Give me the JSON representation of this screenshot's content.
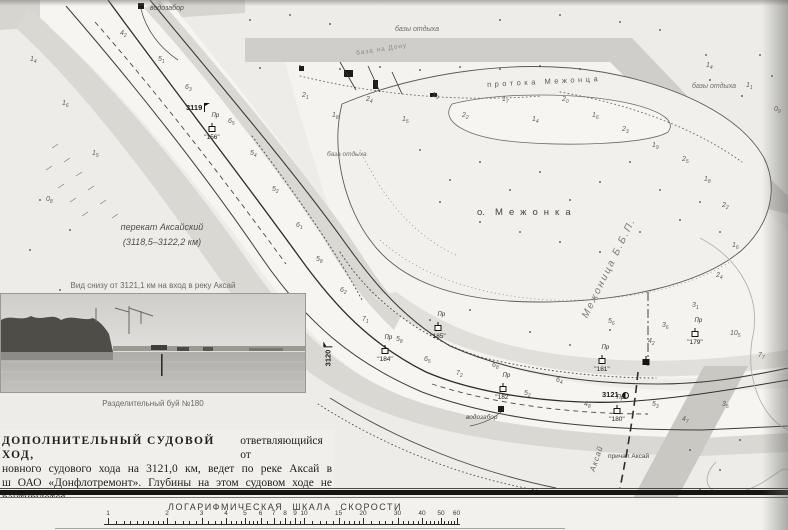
{
  "map": {
    "labels": {
      "vodozabor_top": "водозабор",
      "bazy_otdykha_top": "базы отдыха",
      "baza_na_donu": "база на Дону",
      "bazy_otdykha_right": "базы отдыха",
      "baza_otdykha_mid": "база отдыха",
      "protoka": "протока Межонца",
      "island_prefix": "о.",
      "island_name": "Межонка",
      "perekat_line1": "перекат Аксайский",
      "perekat_line2": "(3118,5–3122,2 км)",
      "side_channel": "Межоница Б.Б.П.",
      "vodozabor_bottom": "водозабор",
      "prichal": "причал Аксай",
      "aksay_river": "Аксай"
    },
    "buoy_prefix": "Пр",
    "km_markers": [
      {
        "x": 186,
        "y": 103,
        "label": "3119",
        "rot": 0,
        "sym": "flag"
      },
      {
        "x": 318,
        "y": 352,
        "label": "3120",
        "rot": -90,
        "sym": "flag"
      },
      {
        "x": 602,
        "y": 390,
        "label": "3121",
        "rot": 0,
        "sym": "circle"
      }
    ],
    "buoys": [
      {
        "x": 212,
        "y": 129,
        "num": "\"156\"",
        "black": false
      },
      {
        "x": 385,
        "y": 351,
        "num": "\"184\"",
        "black": false
      },
      {
        "x": 438,
        "y": 328,
        "num": "\"185\"",
        "black": false
      },
      {
        "x": 503,
        "y": 389,
        "num": "\"182\"",
        "black": false
      },
      {
        "x": 602,
        "y": 361,
        "num": "\"181\"",
        "black": false
      },
      {
        "x": 617,
        "y": 411,
        "num": "\"180\"",
        "black": false
      },
      {
        "x": 695,
        "y": 334,
        "num": "\"179\"",
        "black": false
      },
      {
        "x": 646,
        "y": 362,
        "num": "",
        "black": true
      }
    ],
    "depths": [
      [
        120,
        30,
        "4",
        "2"
      ],
      [
        158,
        56,
        "5",
        "1"
      ],
      [
        185,
        84,
        "6",
        "3"
      ],
      [
        228,
        118,
        "6",
        "5"
      ],
      [
        250,
        150,
        "5",
        "4"
      ],
      [
        272,
        186,
        "5",
        "2"
      ],
      [
        296,
        222,
        "6",
        "1"
      ],
      [
        316,
        256,
        "5",
        "8"
      ],
      [
        340,
        287,
        "6",
        "2"
      ],
      [
        362,
        316,
        "7",
        "1"
      ],
      [
        396,
        336,
        "5",
        "8"
      ],
      [
        424,
        356,
        "6",
        "5"
      ],
      [
        456,
        370,
        "7",
        "2"
      ],
      [
        492,
        362,
        "6",
        "8"
      ],
      [
        524,
        390,
        "5",
        "2"
      ],
      [
        556,
        377,
        "6",
        "4"
      ],
      [
        584,
        401,
        "4",
        "8"
      ],
      [
        652,
        401,
        "5",
        "3"
      ],
      [
        682,
        416,
        "4",
        "7"
      ],
      [
        722,
        401,
        "3",
        "5"
      ],
      [
        30,
        56,
        "1",
        "4"
      ],
      [
        62,
        100,
        "1",
        "6"
      ],
      [
        92,
        150,
        "1",
        "5"
      ],
      [
        46,
        196,
        "0",
        "8"
      ],
      [
        302,
        92,
        "2",
        "1"
      ],
      [
        332,
        112,
        "1",
        "8"
      ],
      [
        366,
        96,
        "2",
        "4"
      ],
      [
        402,
        116,
        "1",
        "5"
      ],
      [
        432,
        92,
        "1",
        "9"
      ],
      [
        462,
        112,
        "2",
        "2"
      ],
      [
        502,
        96,
        "1",
        "7"
      ],
      [
        532,
        116,
        "1",
        "4"
      ],
      [
        562,
        96,
        "2",
        "0"
      ],
      [
        592,
        112,
        "1",
        "6"
      ],
      [
        622,
        126,
        "2",
        "3"
      ],
      [
        652,
        142,
        "1",
        "9"
      ],
      [
        682,
        156,
        "2",
        "5"
      ],
      [
        704,
        176,
        "1",
        "8"
      ],
      [
        722,
        202,
        "2",
        "2"
      ],
      [
        732,
        242,
        "1",
        "6"
      ],
      [
        716,
        272,
        "2",
        "4"
      ],
      [
        692,
        302,
        "3",
        "1"
      ],
      [
        662,
        322,
        "3",
        "6"
      ],
      [
        706,
        62,
        "1",
        "4"
      ],
      [
        746,
        82,
        "1",
        "1"
      ],
      [
        774,
        106,
        "0",
        "9"
      ],
      [
        608,
        318,
        "5",
        "6"
      ],
      [
        648,
        338,
        "4",
        "2"
      ],
      [
        730,
        330,
        "10",
        "5"
      ],
      [
        758,
        352,
        "7",
        "7"
      ]
    ]
  },
  "photo": {
    "caption_top": "Вид снизу от 3121,1 км на вход в реку Аксай",
    "caption_bottom": "Разделительный буй №180"
  },
  "note": {
    "line1_bold": "ДОПОЛНИТЕЛЬНЫЙ СУДОВОЙ ХОД,",
    "line1_rest": "ответвляющийся от",
    "line2": "новного судового хода на 3121,0 км, ведет по реке Аксай в",
    "line3": "ш ОАО «Донфлотремонт». Глубины на этом судовом ходе не",
    "line4": "рантируются."
  },
  "speed_scale": {
    "title": "ЛОГАРИФМИЧЕСКАЯ ШКАЛА СКОРОСТИ",
    "major_ticks": [
      1,
      2,
      3,
      4,
      5,
      6,
      7,
      8,
      9,
      10,
      15,
      20,
      30,
      40,
      50,
      60
    ],
    "minor_ticks": [
      1.1,
      1.2,
      1.3,
      1.4,
      1.5,
      1.6,
      1.7,
      1.8,
      1.9,
      2.2,
      2.4,
      2.6,
      2.8,
      3.25,
      3.5,
      3.75,
      4.25,
      4.5,
      4.75,
      5.25,
      5.5,
      5.75,
      6.5,
      7.5,
      8.5,
      9.5,
      11,
      12,
      13,
      14,
      16,
      17,
      18,
      19,
      22,
      24,
      26,
      28,
      32,
      34,
      36,
      38,
      42,
      44,
      46,
      48,
      52,
      54,
      56,
      58
    ]
  }
}
